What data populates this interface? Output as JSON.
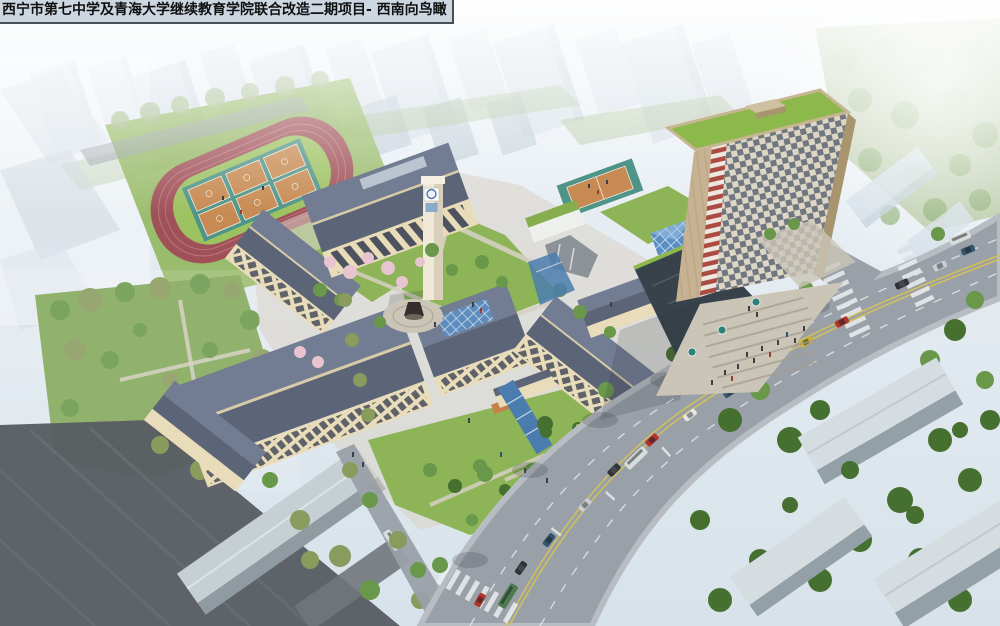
{
  "title": {
    "text": "西宁市第七中学及青海大学继续教育学院联合改造二期项目- 西南向鸟瞰"
  },
  "scene": {
    "type": "architectural-aerial-rendering",
    "landmarks": [
      "running-track",
      "basketball-courts",
      "courtyard-school-buildings",
      "clock-tower",
      "statue-plaza",
      "central-canal",
      "rooftop-sports-court",
      "high-rise-tower",
      "entrance-plaza",
      "arterial-road",
      "city-parks"
    ]
  },
  "palette": {
    "sky_top": "#eef3f7",
    "sky_bottom": "#d7e2ea",
    "city_light": "#cfdae4",
    "city_mid": "#bccad6",
    "tree_hazy": "#a7bc8d",
    "tree_green": "#69984a",
    "tree_dark": "#46702f",
    "tree_olive": "#8a9b5e",
    "blossom_pink": "#e8c4d0",
    "lawn": "#8db457",
    "lawn_bright": "#9cc261",
    "park_green": "#82a858",
    "track_red": "#a05158",
    "track_line": "#c08086",
    "court_teal": "#4f9488",
    "court_orange": "#c78a52",
    "roof_slate": "#5c6478",
    "roof_slate_light": "#727c93",
    "roof_ridge": "#d8cba8",
    "wall_cream": "#e9dcba",
    "wall_shade": "#c9ba94",
    "window_dark": "#3c4354",
    "clock_cream": "#f0e9d8",
    "tower_tan": "#c7b393",
    "tower_tan_dark": "#a8946f",
    "tower_checker_bg": "#ded6c5",
    "tower_checker_dark": "#555f6f",
    "tower_red": "#a63a30",
    "tower_green_roof": "#8db84b",
    "glass_blue": "#5b8fc4",
    "podium_dark": "#37424b",
    "road_gray": "#9aa0a8",
    "marking_white": "#eceff1",
    "marking_yellow": "#d6c254",
    "plaza_tan": "#cbc5b8",
    "step_shadow": "#a39c8f",
    "water_blue": "#4a7cae",
    "slab_white": "#d6dde1",
    "slab_shadow": "#93a0a8",
    "dark_roof": "#585d63",
    "dark_roof_light": "#71767c",
    "statue_dark": "#332f2c",
    "people_dark": "#3a3f4a",
    "title_bg": "#ccd7e1",
    "title_border": "#4a4f55",
    "title_text": "#101010"
  }
}
